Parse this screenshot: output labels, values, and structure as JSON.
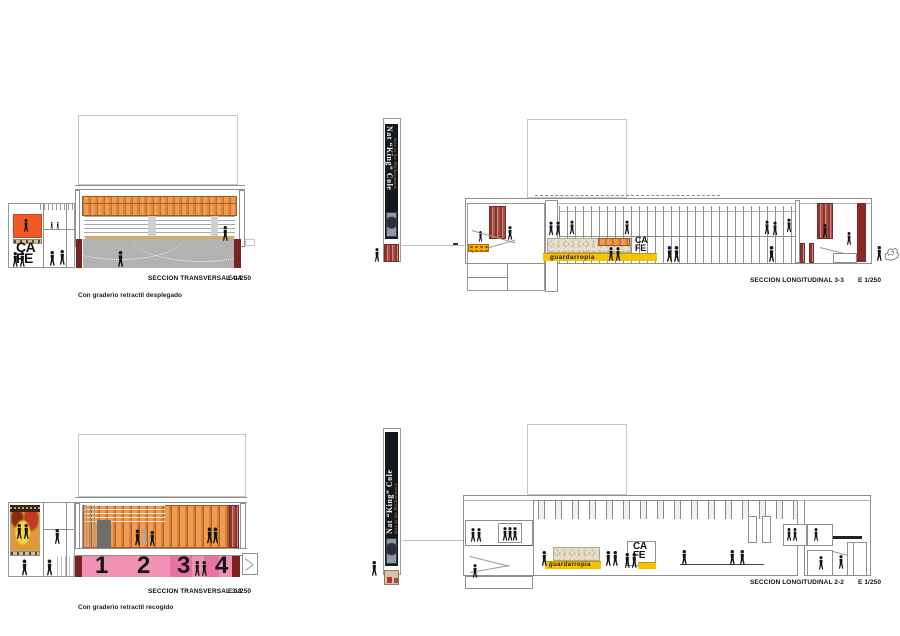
{
  "sheet": {
    "background": "#ffffff"
  },
  "drawings": {
    "t44": {
      "title": "SECCION TRANSVERSAL 4-4",
      "scale": "E 1/250",
      "caption": "Con graderio retractil desplegado"
    },
    "l33": {
      "title": "SECCION LONGITUDINAL 3-3",
      "scale": "E 1/250"
    },
    "t33": {
      "title": "SECCION TRANSVERSAL 3-3",
      "scale": "E 1/250",
      "caption": "Con graderio retractil recogido",
      "sector_numbers": [
        "1",
        "2",
        "3",
        "4"
      ]
    },
    "l22": {
      "title": "SECCION LONGITUDINAL 2-2",
      "scale": "E 1/250"
    }
  },
  "signs": {
    "cafe_line1": "CA",
    "cafe_line2": "FE",
    "wardrobe": "guardarropia"
  },
  "banner": {
    "title": "Nat “King” Cole",
    "subtitle": "Jazz at the Philharmonic"
  },
  "colors": {
    "wood_slats": "#ef9c52",
    "maroon": "#7a2222",
    "dark_red": "#8b2a24",
    "seating_pink": "#f191b4",
    "seating_pink_dark": "#e8739f",
    "signal_yellow": "#f5c400",
    "cafe_orange": "#f15a24",
    "stone_beige": "#e6decd",
    "banner_black": "#14181f",
    "figure_black": "#151515"
  }
}
